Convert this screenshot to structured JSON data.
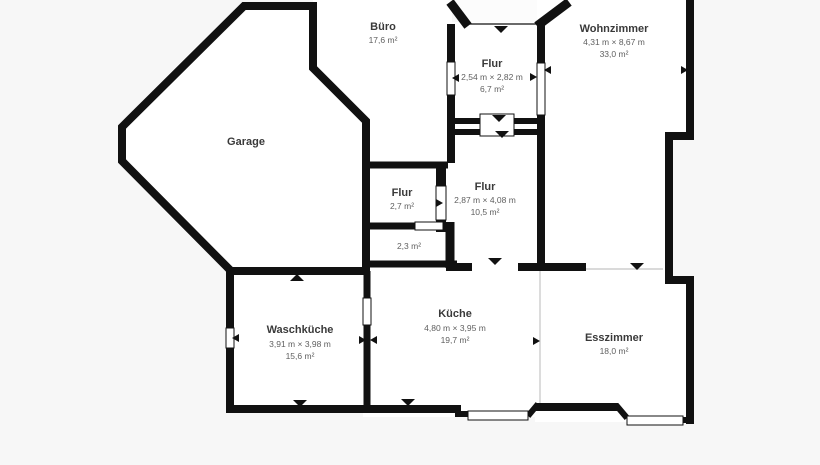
{
  "plan": {
    "type": "floorplan",
    "language": "de",
    "colors": {
      "background": "#f7f7f7",
      "room_fill": "#ffffff",
      "wall": "#111111",
      "open_boundary_line": "#c4c4c4",
      "label_title": "#3a3a3a",
      "label_sub": "#5f5f5f"
    },
    "rooms": [
      {
        "id": "buero",
        "name": "Büro",
        "dims": "",
        "area": "17,6 m²"
      },
      {
        "id": "garage",
        "name": "Garage",
        "dims": "",
        "area": ""
      },
      {
        "id": "flur-top",
        "name": "Flur",
        "dims": "2,54 m × 2,82 m",
        "area": "6,7 m²"
      },
      {
        "id": "wohnzimmer",
        "name": "Wohnzimmer",
        "dims": "4,31 m × 8,67 m",
        "area": "33,0 m²"
      },
      {
        "id": "flur-klein",
        "name": "Flur",
        "dims": "",
        "area": "2,7 m²"
      },
      {
        "id": "flur-mitte",
        "name": "Flur",
        "dims": "2,87 m × 4,08 m",
        "area": "10,5 m²"
      },
      {
        "id": "abstellraum",
        "name": "",
        "dims": "",
        "area": "2,3 m²"
      },
      {
        "id": "waschkueche",
        "name": "Waschküche",
        "dims": "3,91 m × 3,98 m",
        "area": "15,6 m²"
      },
      {
        "id": "kueche",
        "name": "Küche",
        "dims": "4,80 m × 3,95 m",
        "area": "19,7 m²"
      },
      {
        "id": "esszimmer",
        "name": "Esszimmer",
        "dims": "",
        "area": "18,0 m²"
      }
    ]
  }
}
